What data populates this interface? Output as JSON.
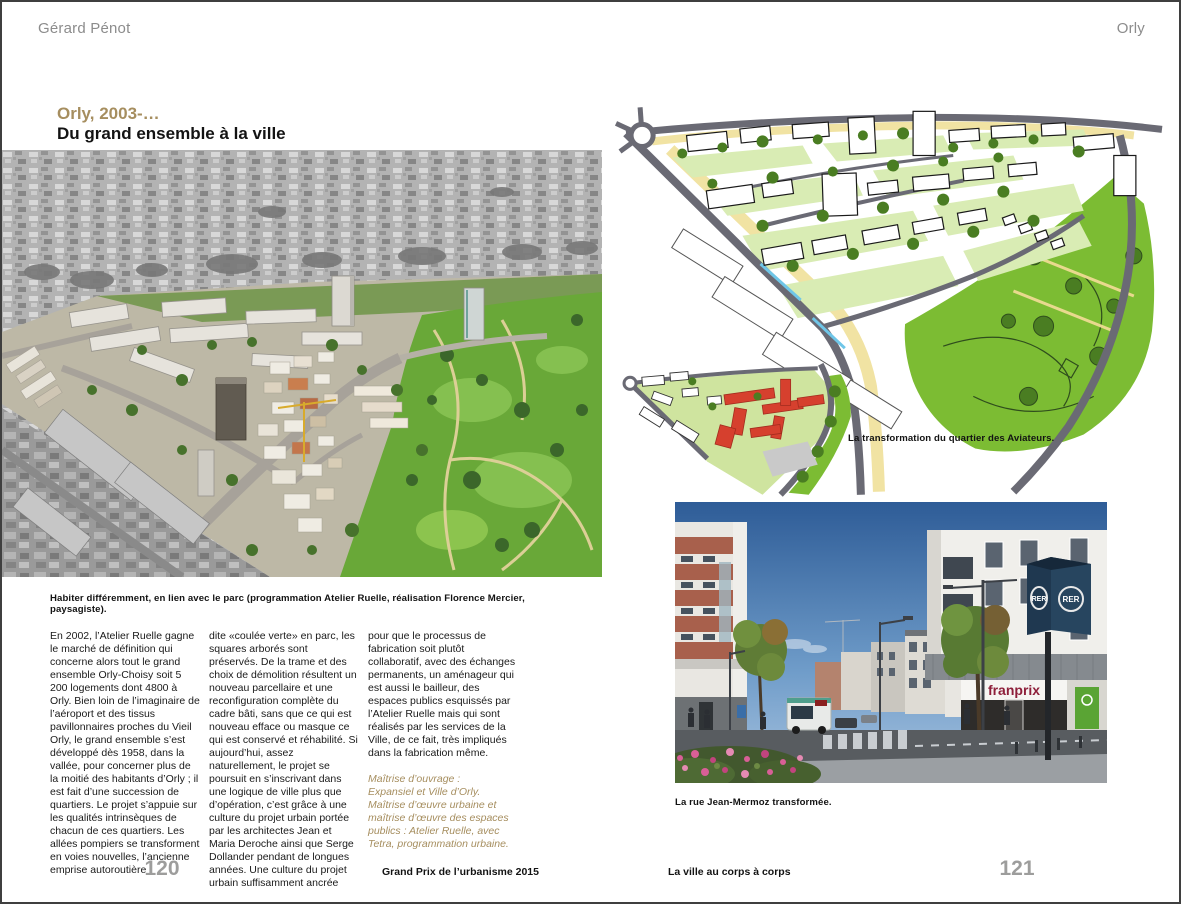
{
  "page_left": {
    "header": "Gérard Pénot",
    "title_line1": "Orly, 2003-…",
    "title_line2": "Du grand ensemble à la ville",
    "photo_caption": "Habiter différemment, en lien avec le parc (programmation Atelier Ruelle, réalisation Florence Mercier, paysagiste).",
    "columns": [
      "En 2002, l’Atelier Ruelle gagne le marché de définition qui concerne alors tout le grand ensemble Orly-Choisy soit 5 200 logements dont 4800 à Orly. Bien loin de l’imaginaire de l’aéroport et des tissus pavillonnaires proches du Vieil Orly, le grand ensemble s’est développé dès 1958, dans la vallée, pour concerner plus de la moitié des habitants d’Orly ; il est fait d’une succession de quartiers. Le projet s’appuie sur les qualités intrinsèques de chacun de ces quartiers. Les allées pompiers se transforment en voies nouvelles, l’ancienne emprise autoroutière",
      "dite «coulée verte» en parc, les squares arborés sont préservés. De la trame et des choix de démolition résultent un nouveau parcellaire et une reconfiguration complète du cadre bâti, sans que ce qui est nouveau efface ou masque ce qui est conservé et réhabilité. Si aujourd’hui, assez naturellement, le projet se poursuit en s’inscrivant dans une logique de ville plus que d’opération, c’est grâce à une culture du projet urbain portée par les architectes Jean et Maria Deroche ainsi que Serge Dollander pendant de longues années. Une culture du projet urbain suffisamment ancrée",
      "pour que le processus de fabrication soit plutôt collaboratif, avec des échanges permanents, un aménageur qui est aussi le bailleur, des espaces publics esquissés par l’Atelier Ruelle mais qui sont réalisés par les services de la Ville, de ce fait, très impliqués dans la fabrication même."
    ],
    "credits": "Maîtrise d’ouvrage :\nExpansiel et Ville d’Orly.\nMaîtrise d’œuvre urbaine et\nmaîtrise d’œuvre des espaces\npublics : Atelier Ruelle, avec\nTetra, programmation urbaine.",
    "page_number": "120",
    "footer": "Grand Prix de l’urbanisme 2015"
  },
  "page_right": {
    "header": "Orly",
    "illustration_caption": "La transformation du quartier des Aviateurs.",
    "photo_caption": "La rue Jean-Mermoz transformée.",
    "footer": "La ville au corps à corps",
    "page_number": "121",
    "street_photo": {
      "shop_sign": "franprix",
      "rer_sign": "RER"
    }
  },
  "colors": {
    "accent_tan": "#a68e5f",
    "page_number_gray": "#9d9d9c",
    "header_gray": "#8c8c8c",
    "park_green": "#76b82a",
    "new_building_red": "#d6402e",
    "rer_navy": "#1f3850",
    "franprix_maroon": "#8e1f3a"
  }
}
